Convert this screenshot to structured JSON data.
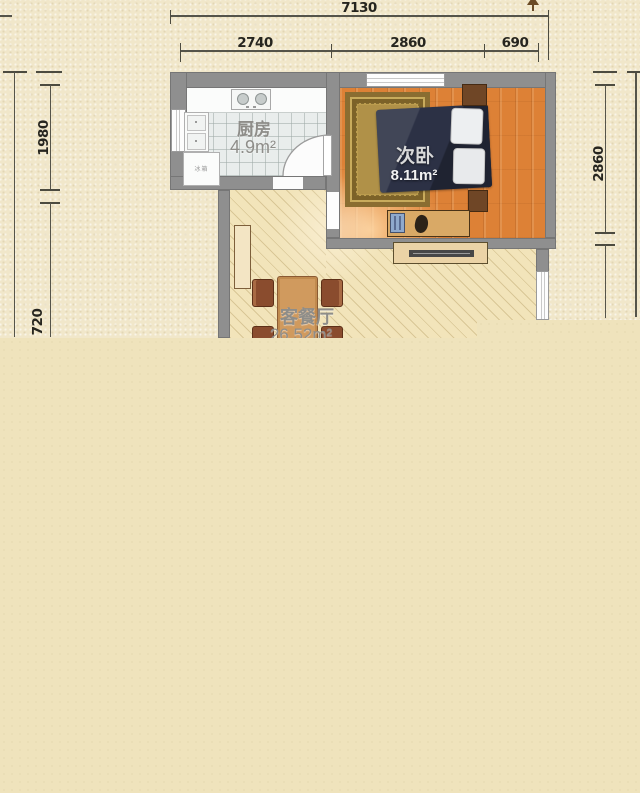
{
  "plan": {
    "dimensions": {
      "top_total": "7130",
      "top_segments": [
        "2740",
        "2860",
        "690"
      ],
      "left_segments": [
        "1980",
        "720"
      ],
      "right_segments": [
        "2860"
      ]
    },
    "rooms": {
      "kitchen": {
        "name": "厨房",
        "area": "4.9m²"
      },
      "bedroom": {
        "name": "次卧",
        "area": "8.11m²"
      },
      "living": {
        "name": "客餐厅",
        "area": "26.52m²"
      }
    },
    "appliances": {
      "fridge_label": "冰箱"
    },
    "colors": {
      "background": "#f0e6c8",
      "flat_fill": "#efe3bc",
      "wall": "#8f8f8f",
      "bedroom_floor": "#dd8136",
      "kitchen_floor": "#e9edec",
      "living_floor": "#f2e4ba",
      "bed": "#2c3145",
      "wood_furniture": "#6f4626",
      "dimension_line": "#55544a"
    }
  }
}
